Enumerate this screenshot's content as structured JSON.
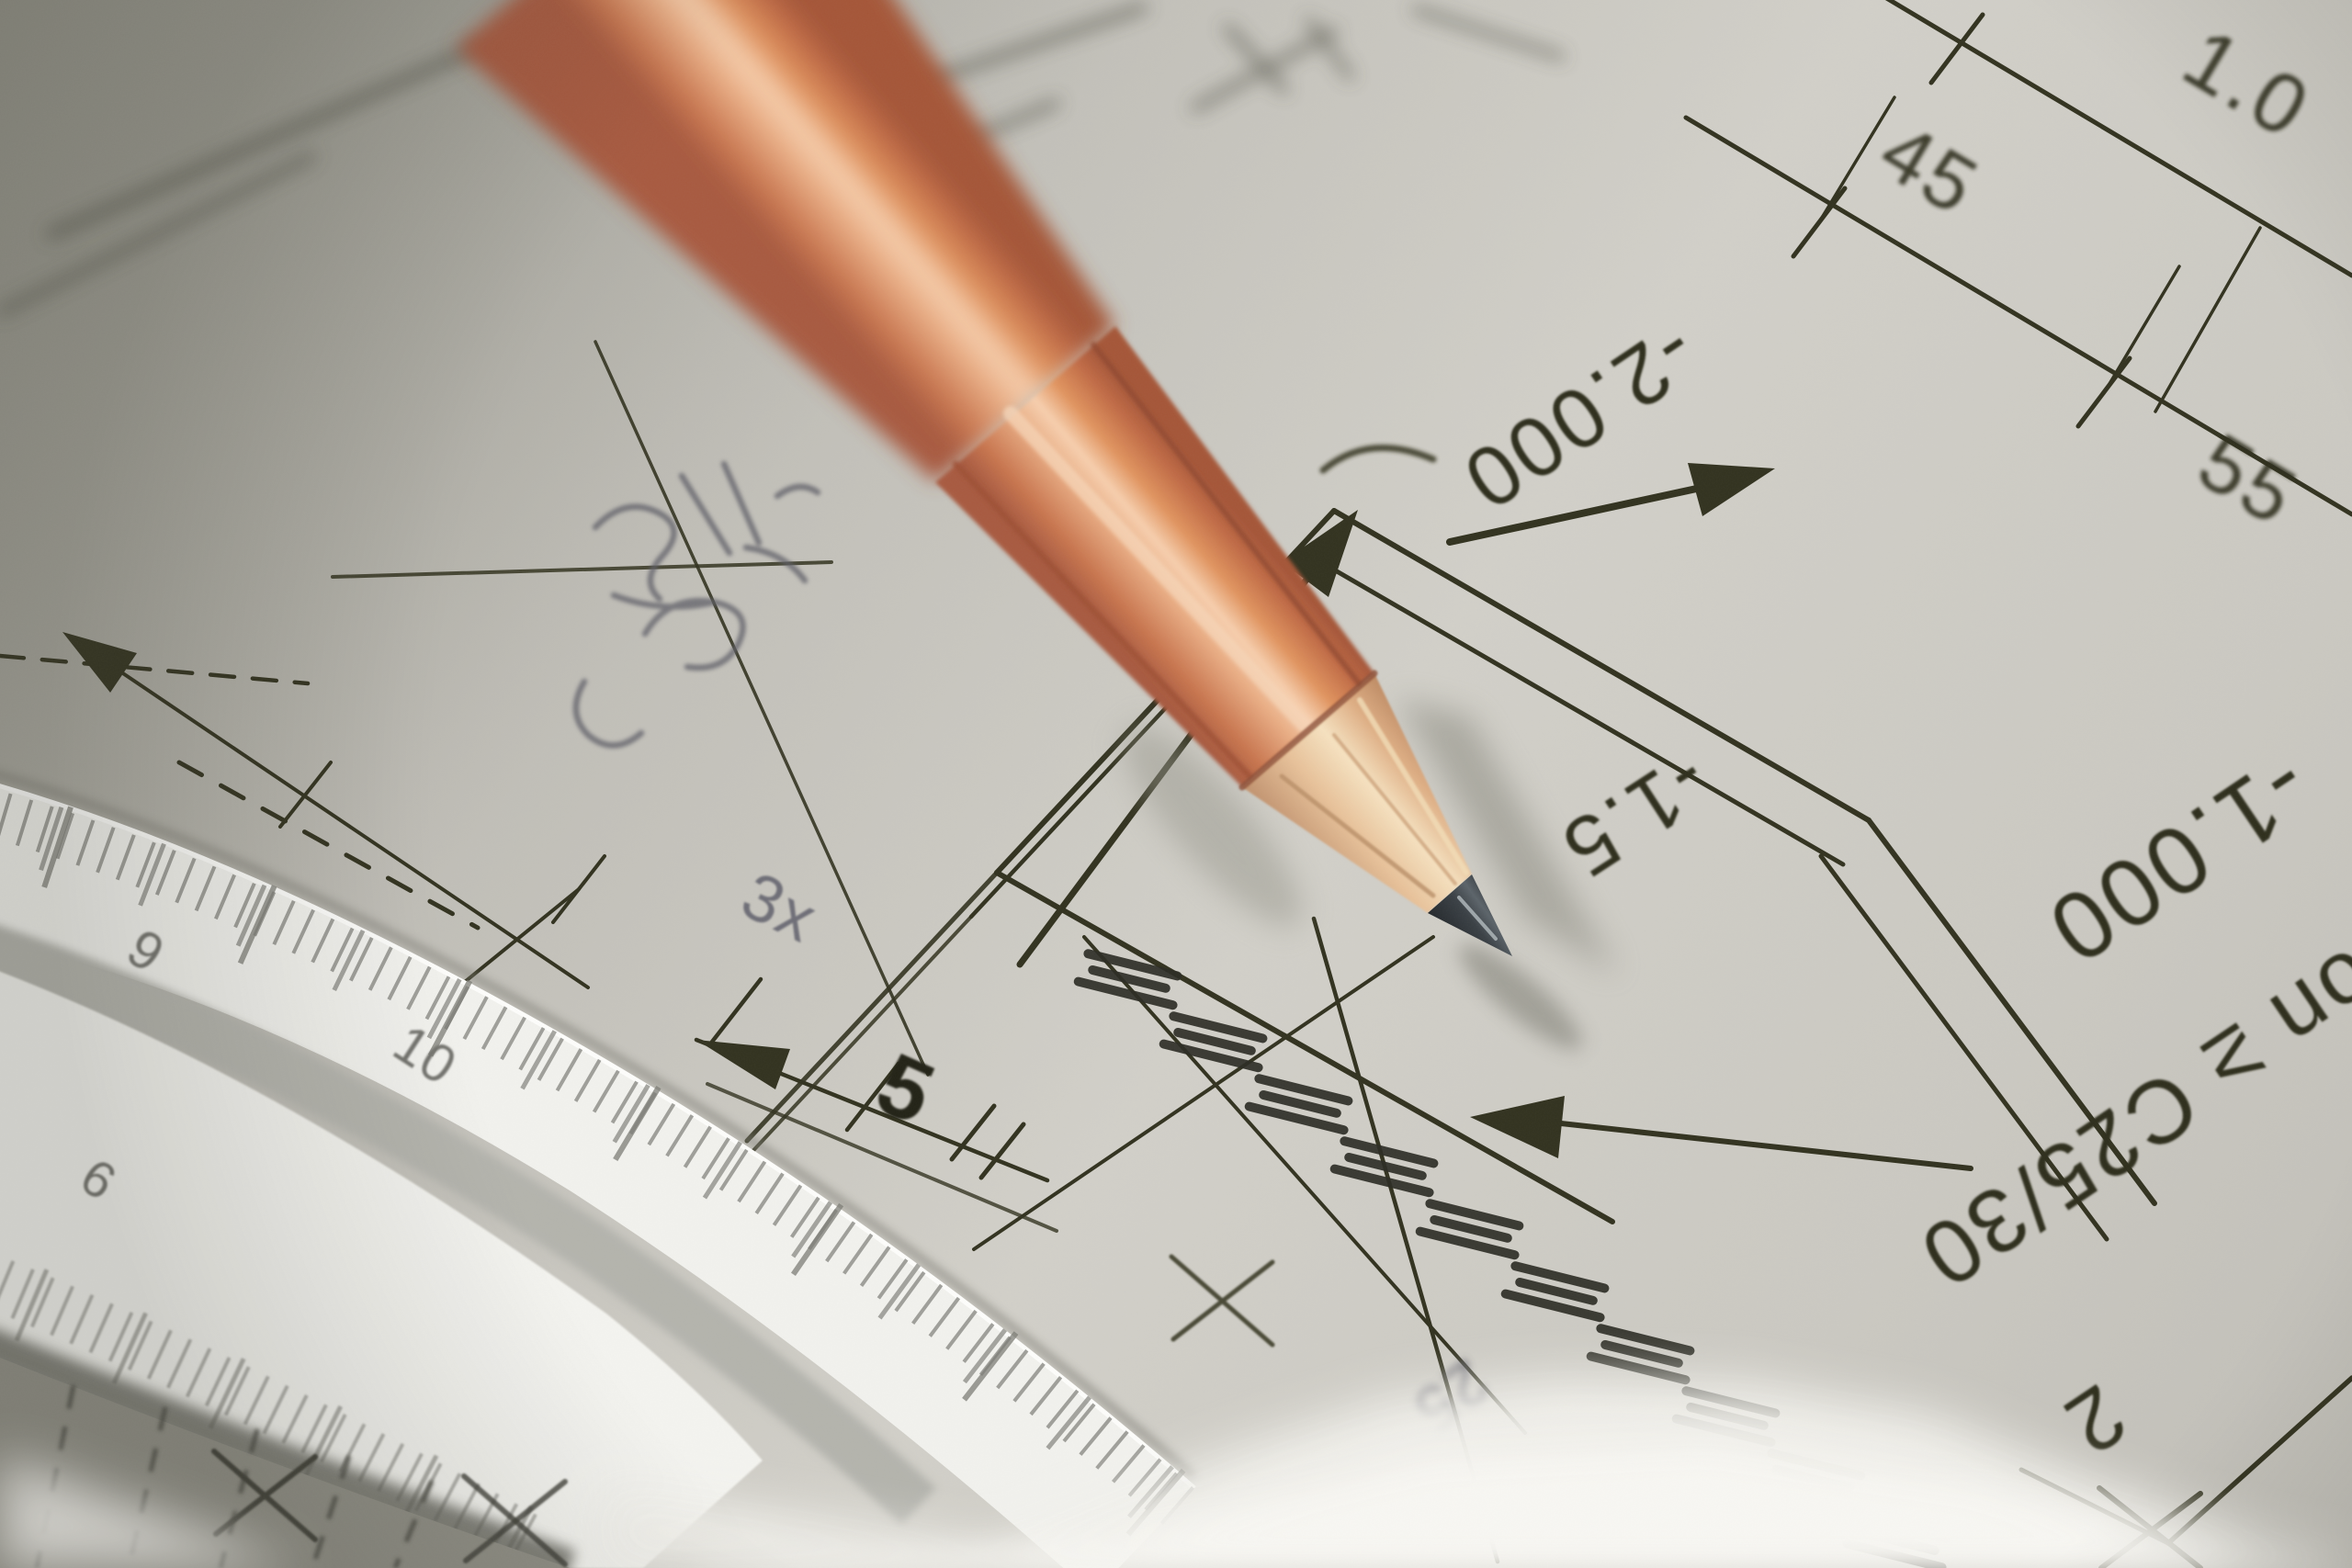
{
  "scene": {
    "subject": "Close-up photograph of a sharpened wooden pencil lying on a structural engineering blueprint with a white scale ruler",
    "palette": {
      "paper": "#c9c7c1",
      "paper_shadow": "#a3a299",
      "drawing_ink": "#32321f",
      "pencil_body": "#d98a68",
      "pencil_highlight": "#f6cfae",
      "pencil_wood": "#eccaa4",
      "graphite_tip": "#2f3438",
      "ruler_white": "#f3f3f0",
      "pencil_graphite_marks": "#5f5f6a"
    }
  },
  "blueprint_labels": {
    "dim_top_right": "1.0",
    "dim_45": "45",
    "dim_55": "55",
    "elevation_minus_2000": "-2.000",
    "elevation_minus_1000": "-1.000",
    "elevation_minus_15": "-1.5",
    "concrete_grade": "on ≥ C25/30",
    "dim_2": "2",
    "dim_25": "25",
    "dim_5": "5"
  },
  "handwritten": {
    "multiplier_note": "3x"
  },
  "ruler": {
    "top_scale": [
      "9",
      "10"
    ],
    "front_scale": [
      "6"
    ]
  }
}
